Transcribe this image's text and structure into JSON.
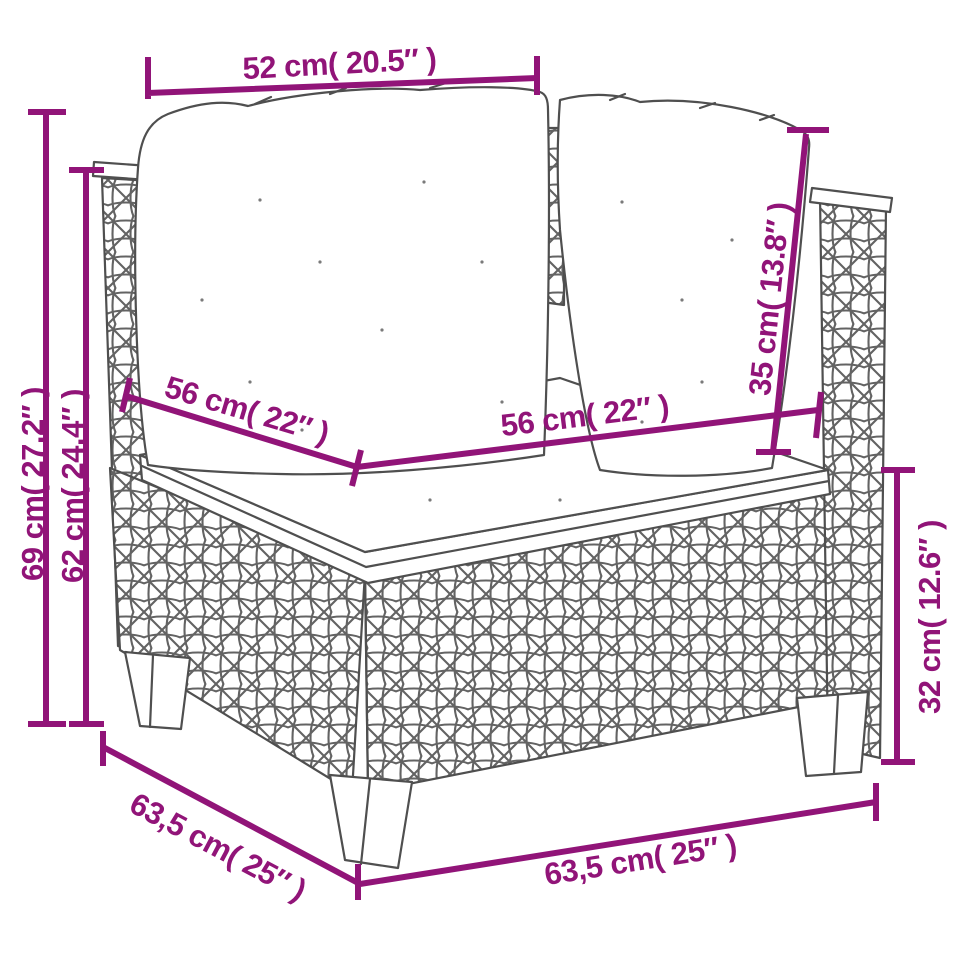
{
  "meta": {
    "title": "Corner sofa dimension diagram",
    "product": "poly rattan corner sofa with back cushions and seat cushion"
  },
  "colors": {
    "accent": "#911478",
    "sketch_line": "#4f4f4f",
    "weave": "#636363",
    "background": "#ffffff"
  },
  "dimensions": {
    "top_width": "52 cm( 20.5″ )",
    "overall_height": "69 cm( 27.2″ )",
    "back_height": "62 cm( 24.4″ )",
    "seat_width_left": "56 cm( 22″ )",
    "seat_width_right": "56 cm( 22″ )",
    "cushion_height": "35 cm( 13.8″ )",
    "base_height": "32 cm( 12.6″ )",
    "base_depth": "63,5 cm( 25″ )",
    "base_width": "63,5 cm( 25″ )"
  }
}
